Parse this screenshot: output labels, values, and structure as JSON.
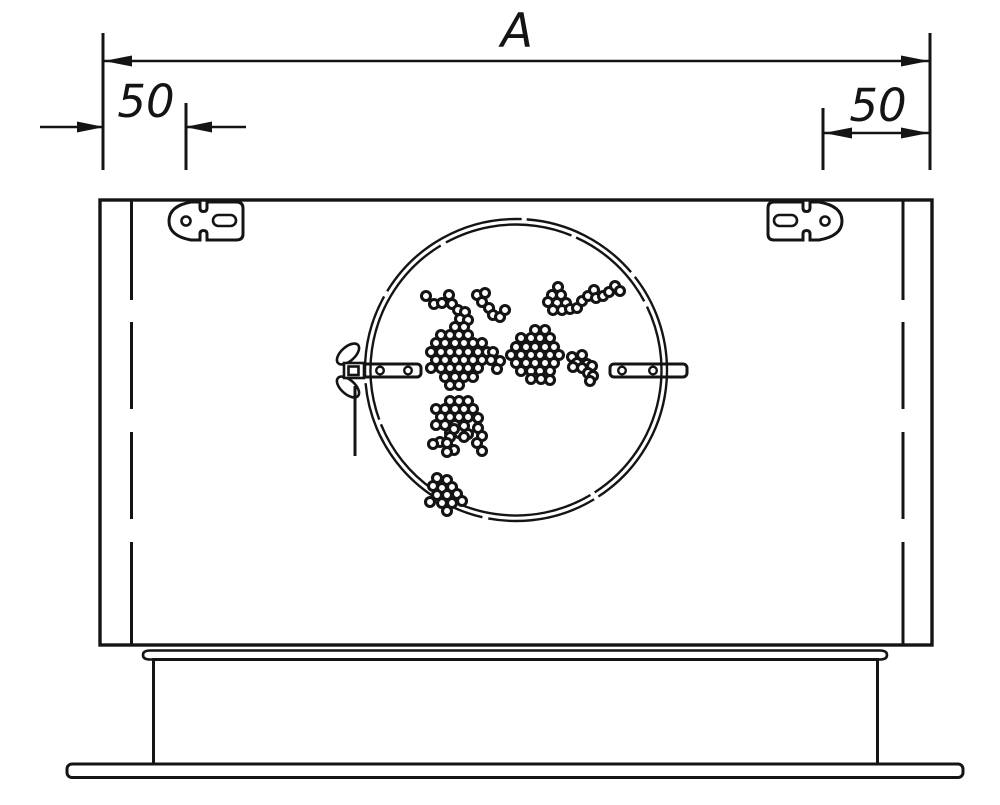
{
  "labels": {
    "overall_width": "A",
    "left_inset": "50",
    "right_inset": "50"
  },
  "perforation_dots": [
    [
      426,
      296
    ],
    [
      434,
      304
    ],
    [
      442,
      303
    ],
    [
      449,
      295
    ],
    [
      452,
      304
    ],
    [
      458,
      310
    ],
    [
      465,
      312
    ],
    [
      460,
      319
    ],
    [
      468,
      320
    ],
    [
      477,
      295
    ],
    [
      485,
      293
    ],
    [
      482,
      302
    ],
    [
      489,
      308
    ],
    [
      493,
      315
    ],
    [
      500,
      317
    ],
    [
      505,
      310
    ],
    [
      455,
      327
    ],
    [
      464,
      327
    ],
    [
      441,
      335
    ],
    [
      450,
      335
    ],
    [
      459,
      335
    ],
    [
      468,
      335
    ],
    [
      436,
      343
    ],
    [
      445,
      343
    ],
    [
      455,
      343
    ],
    [
      464,
      343
    ],
    [
      473,
      343
    ],
    [
      482,
      343
    ],
    [
      431,
      352
    ],
    [
      441,
      352
    ],
    [
      450,
      352
    ],
    [
      459,
      352
    ],
    [
      468,
      352
    ],
    [
      478,
      352
    ],
    [
      487,
      352
    ],
    [
      493,
      352
    ],
    [
      436,
      360
    ],
    [
      445,
      360
    ],
    [
      455,
      360
    ],
    [
      464,
      360
    ],
    [
      473,
      360
    ],
    [
      482,
      360
    ],
    [
      491,
      360
    ],
    [
      500,
      361
    ],
    [
      431,
      368
    ],
    [
      441,
      368
    ],
    [
      450,
      368
    ],
    [
      459,
      368
    ],
    [
      468,
      368
    ],
    [
      478,
      368
    ],
    [
      497,
      369
    ],
    [
      445,
      377
    ],
    [
      455,
      377
    ],
    [
      464,
      377
    ],
    [
      473,
      377
    ],
    [
      450,
      385
    ],
    [
      459,
      385
    ],
    [
      450,
      401
    ],
    [
      459,
      401
    ],
    [
      468,
      401
    ],
    [
      436,
      409
    ],
    [
      445,
      409
    ],
    [
      455,
      409
    ],
    [
      464,
      409
    ],
    [
      473,
      409
    ],
    [
      441,
      417
    ],
    [
      450,
      417
    ],
    [
      459,
      417
    ],
    [
      468,
      417
    ],
    [
      478,
      418
    ],
    [
      436,
      425
    ],
    [
      445,
      425
    ],
    [
      455,
      425
    ],
    [
      464,
      426
    ],
    [
      450,
      433
    ],
    [
      459,
      433
    ],
    [
      468,
      434
    ],
    [
      454,
      429
    ],
    [
      450,
      437
    ],
    [
      464,
      437
    ],
    [
      440,
      442
    ],
    [
      447,
      443
    ],
    [
      433,
      444
    ],
    [
      454,
      450
    ],
    [
      447,
      452
    ],
    [
      478,
      428
    ],
    [
      482,
      436
    ],
    [
      477,
      443
    ],
    [
      482,
      451
    ],
    [
      437,
      478
    ],
    [
      447,
      480
    ],
    [
      433,
      486
    ],
    [
      442,
      488
    ],
    [
      452,
      487
    ],
    [
      437,
      495
    ],
    [
      447,
      495
    ],
    [
      457,
      494
    ],
    [
      430,
      502
    ],
    [
      442,
      503
    ],
    [
      452,
      503
    ],
    [
      462,
      501
    ],
    [
      447,
      511
    ],
    [
      558,
      287
    ],
    [
      552,
      295
    ],
    [
      561,
      295
    ],
    [
      548,
      302
    ],
    [
      557,
      303
    ],
    [
      566,
      303
    ],
    [
      553,
      310
    ],
    [
      562,
      310
    ],
    [
      570,
      309
    ],
    [
      577,
      308
    ],
    [
      582,
      301
    ],
    [
      588,
      296
    ],
    [
      594,
      290
    ],
    [
      596,
      298
    ],
    [
      603,
      296
    ],
    [
      609,
      292
    ],
    [
      615,
      286
    ],
    [
      620,
      291
    ],
    [
      535,
      330
    ],
    [
      545,
      330
    ],
    [
      521,
      338
    ],
    [
      531,
      338
    ],
    [
      540,
      338
    ],
    [
      550,
      338
    ],
    [
      516,
      347
    ],
    [
      526,
      347
    ],
    [
      535,
      347
    ],
    [
      545,
      347
    ],
    [
      554,
      347
    ],
    [
      511,
      355
    ],
    [
      521,
      355
    ],
    [
      531,
      355
    ],
    [
      540,
      355
    ],
    [
      550,
      355
    ],
    [
      559,
      355
    ],
    [
      516,
      363
    ],
    [
      526,
      363
    ],
    [
      535,
      363
    ],
    [
      545,
      363
    ],
    [
      554,
      363
    ],
    [
      521,
      371
    ],
    [
      531,
      371
    ],
    [
      540,
      371
    ],
    [
      550,
      371
    ],
    [
      531,
      379
    ],
    [
      541,
      379
    ],
    [
      550,
      380
    ],
    [
      572,
      357
    ],
    [
      582,
      355
    ],
    [
      577,
      363
    ],
    [
      587,
      364
    ],
    [
      592,
      366
    ],
    [
      573,
      367
    ],
    [
      582,
      368
    ],
    [
      588,
      373
    ],
    [
      593,
      376
    ],
    [
      590,
      381
    ]
  ]
}
